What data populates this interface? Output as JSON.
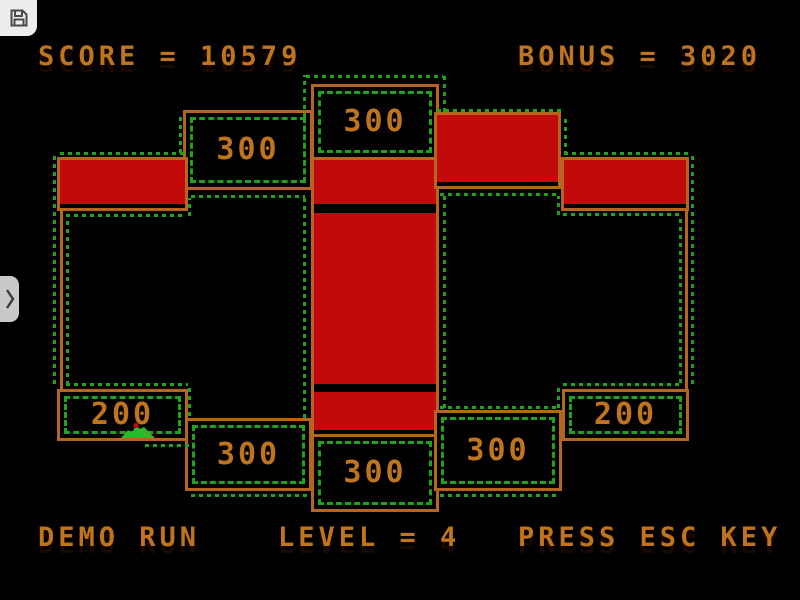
{
  "hud": {
    "score": "SCORE = 10579",
    "bonus": "BONUS = 3020",
    "demo": "DEMO RUN",
    "level": "LEVEL = 4",
    "esc_hint": "PRESS ESC KEY"
  },
  "field": {
    "bonus_boxes": [
      {
        "position": "top-center",
        "value": "300"
      },
      {
        "position": "upper-left",
        "value": "300"
      },
      {
        "position": "lower-left",
        "value": "200"
      },
      {
        "position": "lower-left-mid",
        "value": "300"
      },
      {
        "position": "bottom-center",
        "value": "300"
      },
      {
        "position": "lower-right-mid",
        "value": "300"
      },
      {
        "position": "lower-right",
        "value": "200"
      }
    ],
    "claimed_blocks": [
      "left-bar",
      "top-right-block",
      "right-bar",
      "column-upper",
      "column-main",
      "column-lower"
    ],
    "player_sprite": "green-creature"
  },
  "overlay": {
    "save_icon": "floppy-disk-icon",
    "sidebar_toggle_icon": "chevron-right-icon"
  },
  "colors": {
    "background": "#000000",
    "wall": "#b5651d",
    "text": "#c0741c",
    "claimed_fill": "#c20a0a",
    "dotted": "#1fa31f",
    "sprite": "#2db82d",
    "overlay_bg": "#ededed"
  }
}
